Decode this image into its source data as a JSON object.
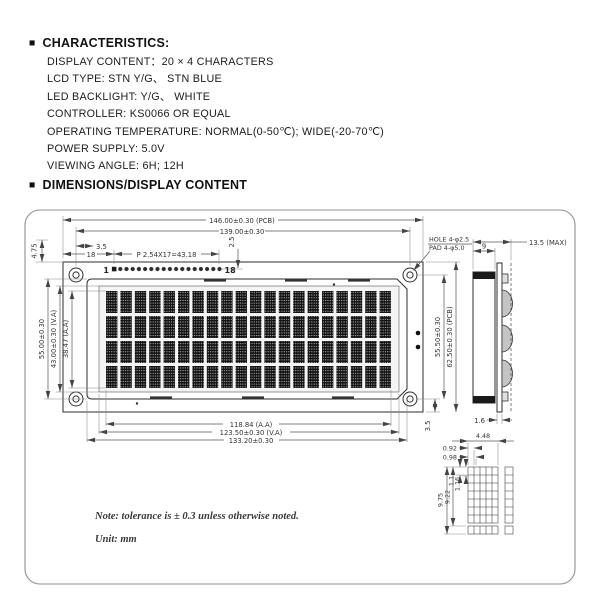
{
  "characteristics": {
    "bullet": "■",
    "title": "CHARACTERISTICS:",
    "items": [
      "DISPLAY CONTENT：20 × 4 CHARACTERS",
      "LCD TYPE: STN Y/G、 STN BLUE",
      "LED BACKLIGHT: Y/G、 WHITE",
      "CONTROLLER: KS0066 OR EQUAL",
      "OPERATING TEMPERATURE: NORMAL(0-50℃); WIDE(-20-70℃)",
      "POWER SUPPLY: 5.0V",
      "VIEWING ANGLE: 6H; 12H"
    ]
  },
  "dimensions_header": {
    "bullet": "■",
    "title": "DIMENSIONS/DISPLAY CONTENT"
  },
  "drawing": {
    "front": {
      "pcb_width": "146.00±0.30 (PCB)",
      "hole_span": "139.00±0.30",
      "top_margin": "4.75",
      "hole_offset": "3.5",
      "pin_offset": "18",
      "pin_pitch": "P 2.54X17=43.18",
      "pin_drop": "2.5",
      "pin_first": "1",
      "pin_last": "18",
      "hole_note_1": "HOLE 4-φ2.5",
      "hole_note_2": "PAD 4-φ5.0",
      "height_holes": "55.50±0.30",
      "height_pcb": "62.50±0.30 (PCB)",
      "bottom_offset": "3.5",
      "height_bezel": "55.00±0.30",
      "height_va": "43.00±0.30 (V.A)",
      "height_aa": "38.47 (A.A)",
      "width_aa": "118.84 (A.A)",
      "width_va": "123.50±0.30 (V.A)",
      "width_bezel": "133.20±0.30"
    },
    "side": {
      "body_depth": "9",
      "max_depth": "13.5 (MAX)",
      "pcb_thickness": "1.6"
    },
    "cell": {
      "char_width": "4.48",
      "dot_width": "0.92",
      "dot_pitch_x": "0.98",
      "char_height": "9.75",
      "char_height2": "9.22",
      "dot_height": "1.1",
      "dot_pitch_y": "1.16"
    },
    "notes": {
      "tolerance": "Note: tolerance is ± 0.3 unless otherwise noted.",
      "unit": "Unit: mm"
    }
  }
}
